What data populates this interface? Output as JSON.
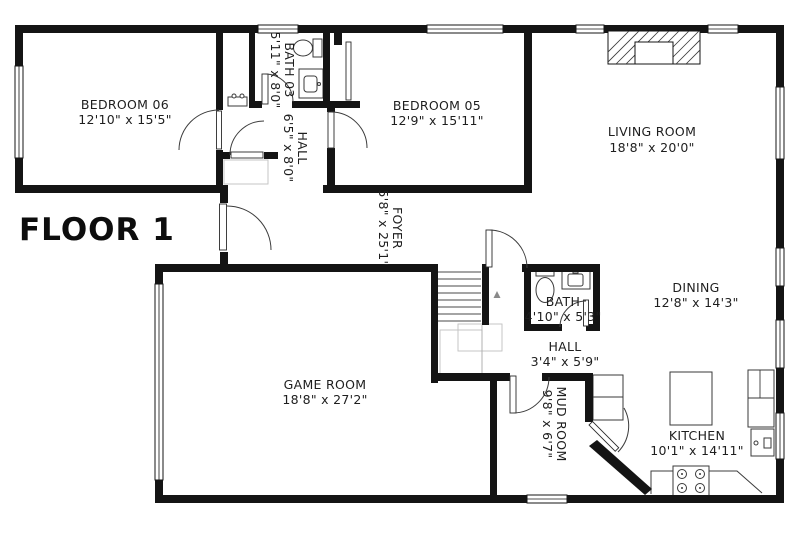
{
  "title": "FLOOR 1",
  "colors": {
    "wall": "#141414",
    "background": "#ffffff",
    "label_text": "#1e1e1e",
    "fixture_outline": "#3a3a3a",
    "understair_gray": "#c0c0c0"
  },
  "rooms": {
    "bedroom06": {
      "name": "BEDROOM 06",
      "dims": "12'10\" x 15'5\""
    },
    "bath03": {
      "name": "BATH 03",
      "dims": "5'11\" x 8'0\""
    },
    "hall_upper": {
      "name": "HALL",
      "dims": "6'5\" x 8'0\""
    },
    "bedroom05": {
      "name": "BEDROOM 05",
      "dims": "12'9\" x 15'11\""
    },
    "living": {
      "name": "LIVING ROOM",
      "dims": "18'8\" x 20'0\""
    },
    "foyer": {
      "name": "FOYER",
      "dims": "5'8\" x 25'1\""
    },
    "dining": {
      "name": "DINING",
      "dims": "12'8\" x 14'3\""
    },
    "bath": {
      "name": "BATH",
      "dims": "4'10\" x 5'3\""
    },
    "hall_lower": {
      "name": "HALL",
      "dims": "3'4\" x 5'9\""
    },
    "game": {
      "name": "GAME ROOM",
      "dims": "18'8\" x 27'2\""
    },
    "mud": {
      "name": "MUD ROOM",
      "dims": "9'8\" x 6'7\""
    },
    "kitchen": {
      "name": "KITCHEN",
      "dims": "10'1\" x 14'11\""
    }
  }
}
